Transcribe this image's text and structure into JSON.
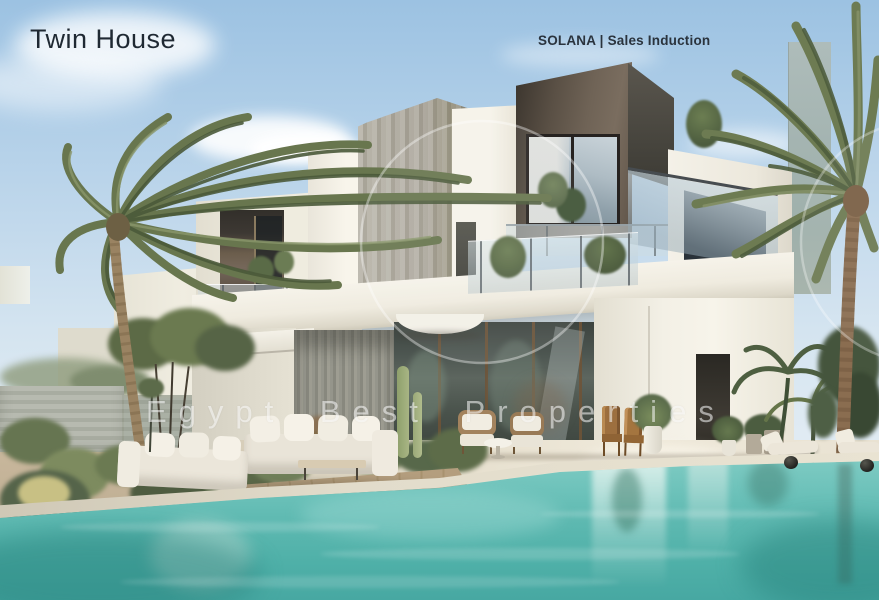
{
  "scene": {
    "kind": "real-estate exterior render",
    "subject": "Modern white two-storey twin house villa with dark roof box, glass balconies, swimming pool, palm trees and outdoor lounge furniture"
  },
  "overlay": {
    "title": "Twin House",
    "project_label": "SOLANA | Sales Induction",
    "watermark": "Egypt Best Properties"
  },
  "palette": {
    "sky_top": "#9cc2e2",
    "sky_horizon": "#e6eef3",
    "villa_white": "#f2efe6",
    "dark_accent_box": "#5f554a",
    "concrete_gray": "#aca899",
    "glass_blue": "#c3d3da",
    "pool_turquoise_light": "#83cdc5",
    "pool_turquoise_deep": "#47a8a2",
    "patio_beige": "#e5dfcf",
    "palm_olive": "#66744c",
    "title_color": "#1f2933",
    "watermark_white": "#ffffff"
  }
}
